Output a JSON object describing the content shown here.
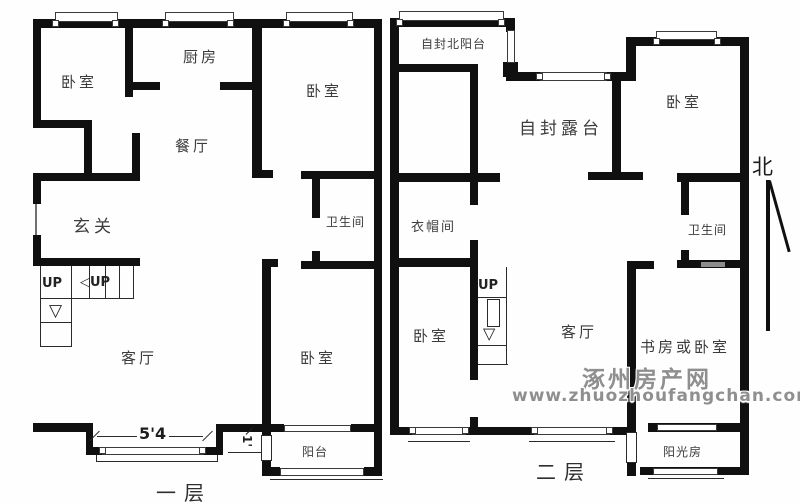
{
  "first_floor": {
    "label": "一层",
    "rooms": {
      "bedroom_top_left": "卧室",
      "kitchen": "厨房",
      "bedroom_top_right": "卧室",
      "dining_room": "餐厅",
      "foyer": "玄关",
      "bathroom": "卫生间",
      "living_room": "客厅",
      "bedroom_bottom": "卧室",
      "balcony": "阳台"
    },
    "stairs_up_label": "UP",
    "stairs_up_side_label": "◁UP",
    "door_width_dim": "5'4",
    "balcony_door_dim": "1'"
  },
  "second_floor": {
    "label": "二层",
    "rooms": {
      "north_balcony": "自封北阳台",
      "terrace": "自封露台",
      "bedroom_top_right": "卧室",
      "cloakroom": "衣帽间",
      "bathroom": "卫生间",
      "bedroom_left": "卧室",
      "living_room": "客厅",
      "study": "书房或卧室",
      "sunroom": "阳光房"
    },
    "stairs_up_label": "UP"
  },
  "compass": {
    "north_label": "北"
  },
  "watermark": {
    "site_name": "涿州房产网",
    "site_url": "www.zhuozhoufangchan.com"
  },
  "icons": {
    "stairs_down_arrow": "▽"
  },
  "colors": {
    "wall": "#101010",
    "label_text": "#3c3c3c",
    "watermark_gray": "#8f8f8f"
  }
}
